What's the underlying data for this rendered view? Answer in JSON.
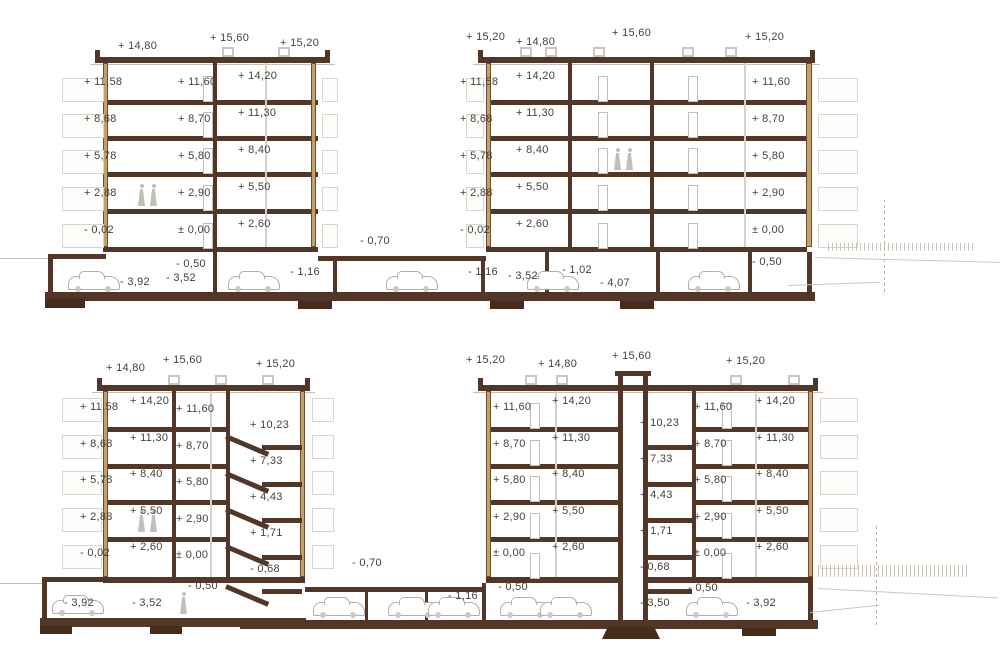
{
  "colors": {
    "slab_brown": "#523627",
    "footing_brown": "#452c1b",
    "wall_tan": "#c2a06c",
    "detail_gray": "#c9c3bb",
    "text": "#45413c"
  },
  "icons": {
    "car_icon": "sedan side silhouette",
    "person_icon": "human figure silhouette"
  },
  "labels": {
    "s1": {
      "roofL": [
        "+ 14,80",
        "+ 15,60",
        "+ 15,20"
      ],
      "bL1": [
        "+ 11,58",
        "+ 8,68",
        "+ 5,78",
        "+ 2,88",
        "- 0,02"
      ],
      "bL2": [
        "+ 11,60",
        "+ 8,70",
        "+ 5,80",
        "+ 2,90",
        "± 0,00"
      ],
      "bL3": [
        "+ 14,20",
        "+ 11,30",
        "+ 8,40",
        "+ 5,50",
        "+ 2,60"
      ],
      "gar": [
        "- 0,50",
        "- 3,92",
        "- 3,52",
        "- 1,16",
        "- 0,70",
        "- 1,16",
        "- 3,52",
        "- 1,02",
        "- 4,07",
        "- 0,50"
      ],
      "roofR": [
        "+ 15,20",
        "+ 14,80",
        "+ 15,60",
        "+ 15,20"
      ],
      "bR1": [
        "+ 11,58",
        "+ 8,68",
        "+ 5,78",
        "+ 2,88",
        "- 0,02"
      ],
      "bR2": [
        "+ 14,20",
        "+ 11,30",
        "+ 8,40",
        "+ 5,50",
        "+ 2,60"
      ],
      "bR3": [
        "+ 11,60",
        "+ 8,70",
        "+ 5,80",
        "+ 2,90",
        "± 0,00"
      ]
    },
    "s2": {
      "roofL": [
        "+ 14,80",
        "+ 15,60",
        "+ 15,20"
      ],
      "bL1": [
        "+ 11,58",
        "+ 8,68",
        "+ 5,78",
        "+ 2,88",
        "- 0,02"
      ],
      "bL2": [
        "+ 14,20",
        "+ 11,30",
        "+ 8,40",
        "+ 5,50",
        "+ 2,60"
      ],
      "bL3": [
        "+ 11,60",
        "+ 8,70",
        "+ 5,80",
        "+ 2,90",
        "± 0,00"
      ],
      "stairsL": [
        "+ 10,23",
        "+ 7,33",
        "+ 4,43",
        "+ 1,71",
        "- 0,68"
      ],
      "basementL": [
        "- 3,92",
        "- 3,52",
        "- 0,50"
      ],
      "mid": [
        "- 0,70",
        "- 1,16",
        "- 0,50"
      ],
      "roofR": [
        "+ 15,20",
        "+ 14,80",
        "+ 15,60",
        "+ 15,20"
      ],
      "bRa1": [
        "+ 11,60",
        "+ 8,70",
        "+ 5,80",
        "+ 2,90",
        "± 0,00"
      ],
      "bRa2": [
        "+ 14,20",
        "+ 11,30",
        "+ 8,40",
        "+ 5,50",
        "+ 2,60"
      ],
      "shaft": [
        "+ 10,23",
        "+ 7,33",
        "+ 4,43",
        "+ 1,71",
        "- 0,68",
        "- 3,50"
      ],
      "bRb1": [
        "+ 11,60",
        "+ 8,70",
        "+ 5,80",
        "+ 2,90",
        "± 0,00"
      ],
      "bRb2": [
        "+ 14,20",
        "+ 11,30",
        "+ 8,40",
        "+ 5,50",
        "+ 2,60"
      ],
      "basementR": [
        "- 0,50",
        "- 3,92"
      ]
    }
  }
}
